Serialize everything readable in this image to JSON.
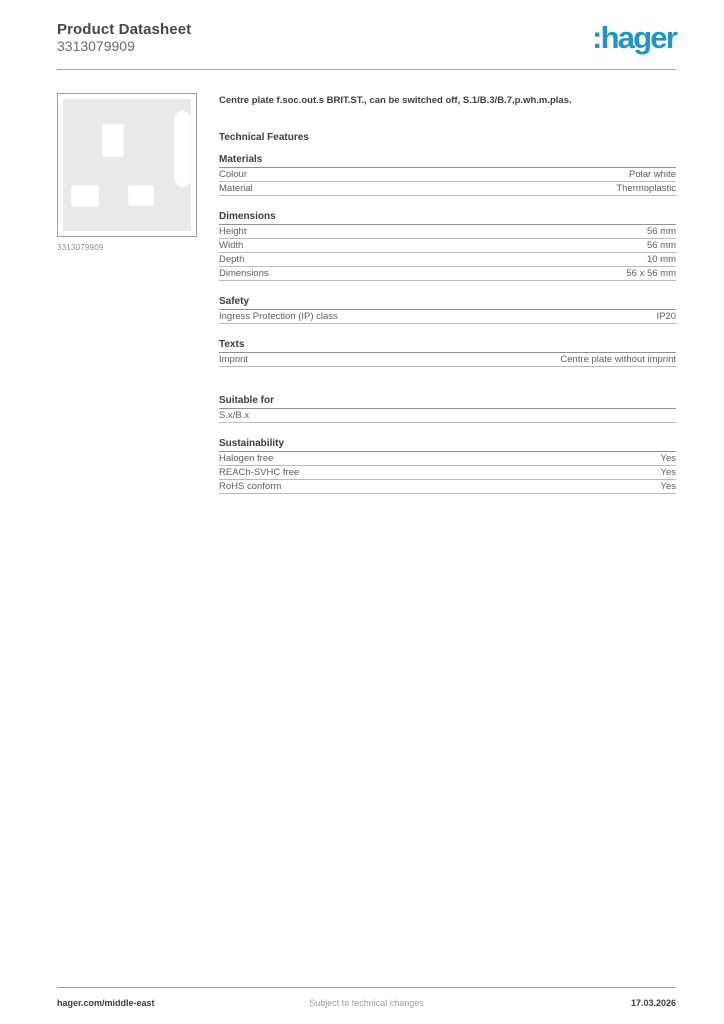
{
  "header": {
    "title": "Product Datasheet",
    "product_number": "3313079909",
    "logo_text": ":hager",
    "brand_color": "#1e96cc"
  },
  "image": {
    "caption": "3313079909"
  },
  "content": {
    "description": "Centre plate f.soc.out.s BRIT.ST., can be switched off, S.1/B.3/B.7,p.wh.m.plas.",
    "technical_features_label": "Technical Features",
    "sections": [
      {
        "title": "Materials",
        "rows": [
          {
            "label": "Colour",
            "value": "Polar white"
          },
          {
            "label": "Material",
            "value": "Thermoplastic"
          }
        ]
      },
      {
        "title": "Dimensions",
        "rows": [
          {
            "label": "Height",
            "value": "56 mm"
          },
          {
            "label": "Width",
            "value": "56 mm"
          },
          {
            "label": "Depth",
            "value": "10 mm"
          },
          {
            "label": "Dimensions",
            "value": "56 x 56 mm"
          }
        ]
      },
      {
        "title": "Safety",
        "rows": [
          {
            "label": "Ingress Protection (IP) class",
            "value": "IP20"
          }
        ]
      },
      {
        "title": "Texts",
        "rows": [
          {
            "label": "Imprint",
            "value": "Centre plate without imprint"
          }
        ]
      },
      {
        "title": "Suitable for",
        "rows": [
          {
            "label": "S.x/B.x",
            "value": ""
          }
        ]
      },
      {
        "title": "Sustainability",
        "rows": [
          {
            "label": "Halogen free",
            "value": "Yes"
          },
          {
            "label": "REACh-SVHC free",
            "value": "Yes"
          },
          {
            "label": "RoHS conform",
            "value": "Yes"
          }
        ]
      }
    ]
  },
  "footer": {
    "website": "hager.com/middle-east",
    "notice": "Subject to technical changes",
    "date": "17.03.2026"
  }
}
